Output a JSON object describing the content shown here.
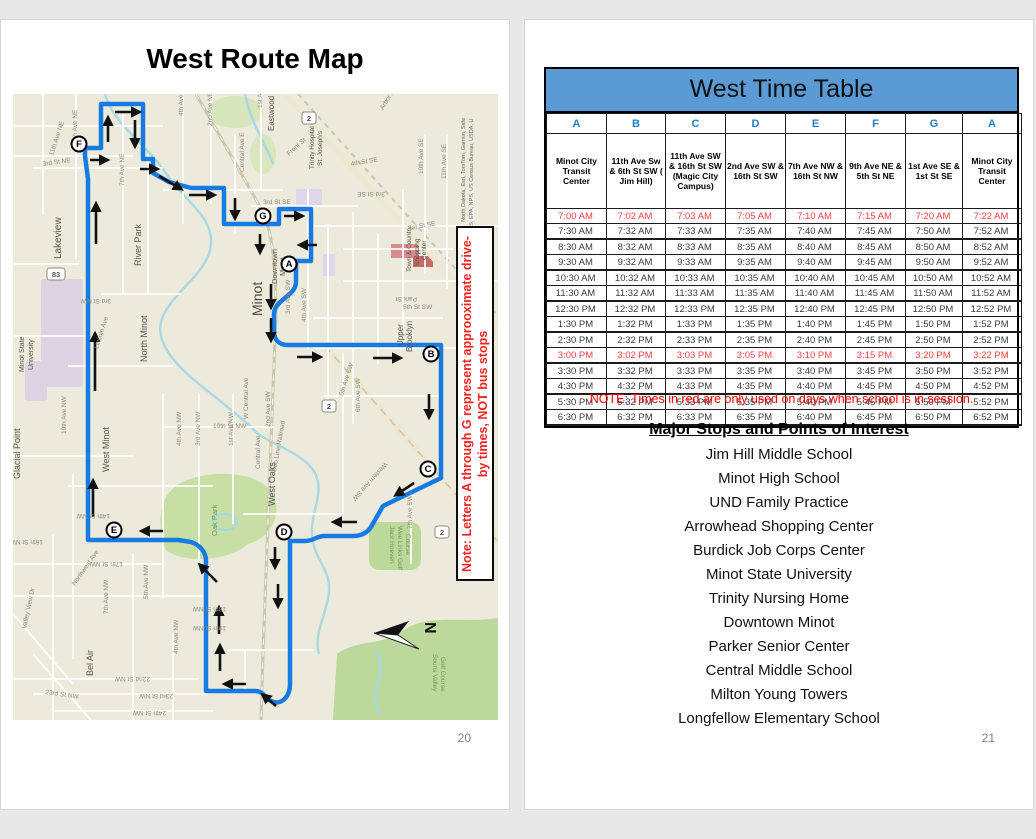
{
  "left_page": {
    "title": "West Route Map",
    "page_number": "20",
    "map": {
      "note": "Note: Letters A through G represent approoximate drive-by times, NOT bus stops",
      "attribution_line1": "North Dakota, Esri, TomTom, Garmin, Safe",
      "attribution_line2": "GS, EPA, NPS, US Census Bureau, USDA, U",
      "compass_label": "N",
      "route_color": "#187be4",
      "markers": [
        {
          "letter": "F",
          "x": 66,
          "y": 50
        },
        {
          "letter": "G",
          "x": 250,
          "y": 122
        },
        {
          "letter": "A",
          "x": 276,
          "y": 170
        },
        {
          "letter": "B",
          "x": 418,
          "y": 260
        },
        {
          "letter": "C",
          "x": 415,
          "y": 375
        },
        {
          "letter": "D",
          "x": 271,
          "y": 438
        },
        {
          "letter": "E",
          "x": 101,
          "y": 436
        }
      ],
      "badges": [
        {
          "label": "83",
          "x": 43,
          "y": 180
        },
        {
          "label": "2",
          "x": 296,
          "y": 24
        },
        {
          "label": "2",
          "x": 316,
          "y": 312
        },
        {
          "label": "2",
          "x": 429,
          "y": 438
        }
      ],
      "place_labels": [
        {
          "t": "Lakeview",
          "x": 48,
          "y": 165,
          "s": 10,
          "r": -90
        },
        {
          "t": "River Park",
          "x": 128,
          "y": 172,
          "s": 9,
          "r": -90
        },
        {
          "t": "North Minot",
          "x": 134,
          "y": 268,
          "s": 9,
          "r": -90
        },
        {
          "t": "Minot State",
          "x": 11,
          "y": 278,
          "s": 7,
          "r": -90
        },
        {
          "t": "University",
          "x": 20,
          "y": 276,
          "s": 7,
          "r": -90
        },
        {
          "t": "West Minot",
          "x": 96,
          "y": 378,
          "s": 9,
          "r": -90
        },
        {
          "t": "Glacial Point",
          "x": 7,
          "y": 385,
          "s": 9,
          "r": -90
        },
        {
          "t": "Bel Air",
          "x": 80,
          "y": 582,
          "s": 9,
          "r": -90
        },
        {
          "t": "West Oaks",
          "x": 262,
          "y": 412,
          "s": 9,
          "r": -90
        },
        {
          "t": "Minot",
          "x": 249,
          "y": 222,
          "s": 14,
          "r": -90,
          "c": "#4a4a42"
        },
        {
          "t": "Downtown",
          "x": 264,
          "y": 190,
          "s": 7.5,
          "r": -90
        },
        {
          "t": "Minot",
          "x": 272,
          "y": 182,
          "s": 7.5,
          "r": -90
        },
        {
          "t": "Upper",
          "x": 390,
          "y": 252,
          "s": 8,
          "r": -90
        },
        {
          "t": "Brooklyn",
          "x": 399,
          "y": 258,
          "s": 8,
          "r": -90
        },
        {
          "t": "Eastwood",
          "x": 261,
          "y": 37,
          "s": 8,
          "r": -90
        },
        {
          "t": "Trinity Hospital",
          "x": 301,
          "y": 75,
          "s": 6.5,
          "r": -90
        },
        {
          "t": "St. Joseph's",
          "x": 309,
          "y": 72,
          "s": 6.5,
          "r": -90
        },
        {
          "t": "Town & Country",
          "x": 398,
          "y": 178,
          "s": 6.5,
          "r": -90
        },
        {
          "t": "Shopping",
          "x": 406,
          "y": 172,
          "s": 6.5,
          "r": -90
        },
        {
          "t": "Center",
          "x": 413,
          "y": 166,
          "s": 6.5,
          "r": -90
        },
        {
          "t": "Oak Park",
          "x": 204,
          "y": 442,
          "s": 7.5,
          "r": -90,
          "c": "#739a53"
        },
        {
          "t": "Jack Hoeven",
          "x": 377,
          "y": 432,
          "s": 6.5,
          "r": 90,
          "c": "#739a53"
        },
        {
          "t": "Wee Links Golf",
          "x": 385,
          "y": 432,
          "s": 6.5,
          "r": 90,
          "c": "#739a53"
        },
        {
          "t": "Course",
          "x": 393,
          "y": 440,
          "s": 6.5,
          "r": 90,
          "c": "#739a53"
        },
        {
          "t": "Souris Valley",
          "x": 420,
          "y": 560,
          "s": 6.5,
          "r": 90,
          "c": "#739a53"
        },
        {
          "t": "Golf Course",
          "x": 428,
          "y": 563,
          "s": 6.5,
          "r": 90,
          "c": "#739a53"
        }
      ],
      "street_labels": [
        {
          "t": "9th Ave NE",
          "x": 64,
          "y": 48,
          "r": -90
        },
        {
          "t": "11th Ave NE",
          "x": 40,
          "y": 62,
          "r": -72
        },
        {
          "t": "7th Ave NE",
          "x": 111,
          "y": 92,
          "r": -90
        },
        {
          "t": "4th Ave",
          "x": 170,
          "y": 22,
          "r": -90
        },
        {
          "t": "2nd Ave NE",
          "x": 199,
          "y": 32,
          "r": -90
        },
        {
          "t": "1st Ave",
          "x": 249,
          "y": 14,
          "r": -90
        },
        {
          "t": "Central Ave E",
          "x": 231,
          "y": 78,
          "r": -90
        },
        {
          "t": "Front St",
          "x": 276,
          "y": 62,
          "r": -42
        },
        {
          "t": "3rd St NE",
          "x": 30,
          "y": 72,
          "r": -8
        },
        {
          "t": "3rd St SE",
          "x": 250,
          "y": 110,
          "r": 0
        },
        {
          "t": "3rd St SE",
          "x": 372,
          "y": 98,
          "r": 180
        },
        {
          "t": "4th St SE",
          "x": 338,
          "y": 72,
          "r": -10
        },
        {
          "t": "10th Ave SE",
          "x": 410,
          "y": 80,
          "r": -90
        },
        {
          "t": "11th Ave SE",
          "x": 433,
          "y": 85,
          "r": -90
        },
        {
          "t": "Arbor A",
          "x": 370,
          "y": 16,
          "r": -58
        },
        {
          "t": "1st St SE",
          "x": 396,
          "y": 136,
          "r": -10
        },
        {
          "t": "Park St",
          "x": 404,
          "y": 203,
          "r": 180
        },
        {
          "t": "5th St SW",
          "x": 390,
          "y": 215,
          "r": 0
        },
        {
          "t": "3rd Ave SW",
          "x": 277,
          "y": 220,
          "r": -90
        },
        {
          "t": "4th Ave SW",
          "x": 293,
          "y": 228,
          "r": -90
        },
        {
          "t": "1st Ave NW",
          "x": 220,
          "y": 352,
          "r": -90
        },
        {
          "t": "3rd Ave NW",
          "x": 187,
          "y": 352,
          "r": -90
        },
        {
          "t": "4th Ave NW",
          "x": 168,
          "y": 352,
          "r": -90
        },
        {
          "t": "Central Ave",
          "x": 247,
          "y": 375,
          "r": -90
        },
        {
          "t": "Soo Line Railroad",
          "x": 263,
          "y": 378,
          "r": -80
        },
        {
          "t": "10th St NW",
          "x": 200,
          "y": 334,
          "r": 0
        },
        {
          "t": "W Central Ave",
          "x": 235,
          "y": 325,
          "r": -90
        },
        {
          "t": "2nd Ave SW",
          "x": 257,
          "y": 333,
          "r": -90
        },
        {
          "t": "5th Ave SW",
          "x": 330,
          "y": 302,
          "r": -72
        },
        {
          "t": "6th Ave SW",
          "x": 347,
          "y": 318,
          "r": -90
        },
        {
          "t": "Western Ave SW",
          "x": 372,
          "y": 368,
          "r": 132
        },
        {
          "t": "7th Ave SW",
          "x": 399,
          "y": 435,
          "r": -90
        },
        {
          "t": "Lincoln Ave",
          "x": 85,
          "y": 255,
          "r": -72
        },
        {
          "t": "3rd St NW",
          "x": 98,
          "y": 205,
          "r": 180
        },
        {
          "t": "10th Ave NW",
          "x": 53,
          "y": 340,
          "r": -90
        },
        {
          "t": "16th St NW",
          "x": 30,
          "y": 446,
          "r": 180
        },
        {
          "t": "14th St NW",
          "x": 97,
          "y": 420,
          "r": 180
        },
        {
          "t": "17th St NW",
          "x": 110,
          "y": 468,
          "r": 180
        },
        {
          "t": "18th St NW",
          "x": 213,
          "y": 513,
          "r": 180
        },
        {
          "t": "19th St NW",
          "x": 213,
          "y": 532,
          "r": 180
        },
        {
          "t": "22nd St NW",
          "x": 137,
          "y": 583,
          "r": 180
        },
        {
          "t": "23rd St NW",
          "x": 160,
          "y": 600,
          "r": 180
        },
        {
          "t": "23rd St NW",
          "x": 32,
          "y": 600,
          "r": 8
        },
        {
          "t": "24th St NW",
          "x": 153,
          "y": 617,
          "r": 180
        },
        {
          "t": "25th St NW",
          "x": 100,
          "y": 632,
          "r": 0
        },
        {
          "t": "26th St NW",
          "x": 130,
          "y": 650,
          "r": 180
        },
        {
          "t": "Northwest Ave",
          "x": 62,
          "y": 492,
          "r": -55
        },
        {
          "t": "Valley View Dr",
          "x": 13,
          "y": 535,
          "r": -78
        },
        {
          "t": "7th Ave NW",
          "x": 95,
          "y": 520,
          "r": -90
        },
        {
          "t": "5th Ave NW",
          "x": 135,
          "y": 505,
          "r": -90
        },
        {
          "t": "4th Ave NW",
          "x": 165,
          "y": 560,
          "r": -90
        }
      ]
    }
  },
  "right_page": {
    "page_number": "21",
    "timetable": {
      "title": "West Time Table",
      "letters": [
        "A",
        "B",
        "C",
        "D",
        "E",
        "F",
        "G",
        "A"
      ],
      "stations": [
        "Minot City Transit Center",
        "11th Ave Sw & 6th  St SW ( Jim Hill)",
        "11th Ave SW & 16th St SW (Magic City Campus)",
        "2nd Ave SW & 16th St SW",
        "7th Ave NW & 16th St NW",
        "9th Ave NE & 5th St NE",
        "1st Ave SE & 1st St SE",
        "Minot City Transit Center"
      ],
      "rows": [
        {
          "red": true,
          "times": [
            "7:00 AM",
            "7:02 AM",
            "7:03 AM",
            "7:05 AM",
            "7:10 AM",
            "7:15 AM",
            "7:20 AM",
            "7:22 AM"
          ]
        },
        {
          "red": false,
          "times": [
            "7:30 AM",
            "7:32 AM",
            "7:33 AM",
            "7:35 AM",
            "7:40 AM",
            "7:45 AM",
            "7:50 AM",
            "7:52 AM"
          ]
        },
        {
          "red": false,
          "times": [
            "8:30 AM",
            "8:32 AM",
            "8:33 AM",
            "8:35 AM",
            "8:40 AM",
            "8:45 AM",
            "8:50 AM",
            "8:52 AM"
          ]
        },
        {
          "red": false,
          "times": [
            "9:30 AM",
            "9:32 AM",
            "9:33 AM",
            "9:35 AM",
            "9:40 AM",
            "9:45 AM",
            "9:50 AM",
            "9:52 AM"
          ]
        },
        {
          "red": false,
          "times": [
            "10:30 AM",
            "10:32 AM",
            "10:33 AM",
            "10:35 AM",
            "10:40 AM",
            "10:45 AM",
            "10:50 AM",
            "10:52 AM"
          ]
        },
        {
          "red": false,
          "times": [
            "11:30 AM",
            "11:32 AM",
            "11:33 AM",
            "11:35 AM",
            "11:40 AM",
            "11:45 AM",
            "11:50 AM",
            "11:52 AM"
          ]
        },
        {
          "red": false,
          "times": [
            "12:30 PM",
            "12:32 PM",
            "12:33 PM",
            "12:35 PM",
            "12:40 PM",
            "12:45 PM",
            "12:50 PM",
            "12:52 PM"
          ]
        },
        {
          "red": false,
          "times": [
            "1:30 PM",
            "1:32 PM",
            "1:33 PM",
            "1:35 PM",
            "1:40 PM",
            "1:45 PM",
            "1:50 PM",
            "1:52 PM"
          ]
        },
        {
          "red": false,
          "times": [
            "2:30 PM",
            "2:32 PM",
            "2:33 PM",
            "2:35 PM",
            "2:40 PM",
            "2:45 PM",
            "2:50 PM",
            "2:52 PM"
          ]
        },
        {
          "red": true,
          "times": [
            "3:00 PM",
            "3:02 PM",
            "3:03 PM",
            "3:05 PM",
            "3:10 PM",
            "3:15 PM",
            "3:20 PM",
            "3:22 PM"
          ]
        },
        {
          "red": false,
          "times": [
            "3:30 PM",
            "3:32 PM",
            "3:33 PM",
            "3:35 PM",
            "3:40 PM",
            "3:45 PM",
            "3:50 PM",
            "3:52 PM"
          ]
        },
        {
          "red": false,
          "times": [
            "4:30 PM",
            "4:32 PM",
            "4:33 PM",
            "4:35 PM",
            "4:40 PM",
            "4:45 PM",
            "4:50 PM",
            "4:52 PM"
          ]
        },
        {
          "red": false,
          "times": [
            "5:30 PM",
            "5:32 PM",
            "5:33 PM",
            "5:35 PM",
            "5:40 PM",
            "5:45 PM",
            "5:50 PM",
            "5:52 PM"
          ]
        },
        {
          "red": false,
          "times": [
            "6:30 PM",
            "6:32 PM",
            "6:33 PM",
            "6:35 PM",
            "6:40 PM",
            "6:45 PM",
            "6:50 PM",
            "6:52 PM"
          ]
        }
      ]
    },
    "note": "NOTE: Times in red are only used on days when school is in session.",
    "stops": {
      "heading": "Major Stops and Points of Interest",
      "items": [
        "Jim Hill Middle School",
        "Minot High School",
        "UND Family Practice",
        "Arrowhead Shopping Center",
        "Burdick Job Corps Center",
        "Minot State University",
        "Trinity Nursing Home",
        "Downtown Minot",
        "Parker Senior Center",
        "Central Middle School",
        "Milton Young Towers",
        "Longfellow Elementary School"
      ]
    }
  },
  "colors": {
    "table_header_bg": "#5b9bd5",
    "letter_blue": "#1e7fc9",
    "time_red": "#ff4040",
    "note_red": "#ff0000",
    "page_number_gray": "#7f7f7f"
  }
}
